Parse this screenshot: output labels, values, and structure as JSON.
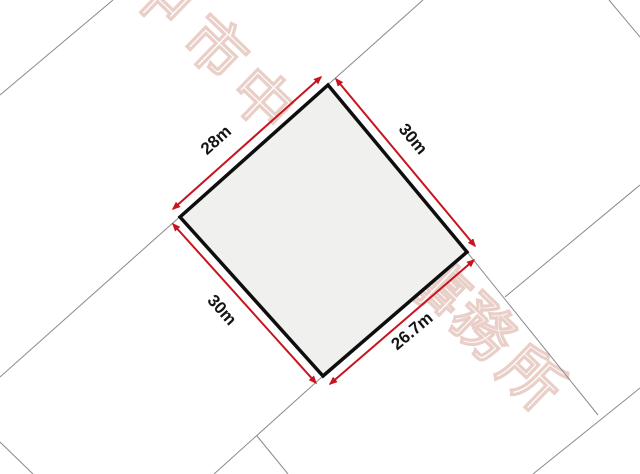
{
  "parcel": {
    "shape": "quadrilateral",
    "sides": [
      {
        "position": "top-left",
        "length_label": "28m",
        "length_m": 28
      },
      {
        "position": "top-right",
        "length_label": "30m",
        "length_m": 30
      },
      {
        "position": "bottom-left",
        "length_label": "30m",
        "length_m": 30
      },
      {
        "position": "bottom-right",
        "length_label": "26.7m",
        "length_m": 26.7
      }
    ]
  },
  "watermark": {
    "visible_text": "中市中事務所",
    "chars": [
      {
        "char": "中"
      },
      {
        "char": "市"
      },
      {
        "char": "中"
      },
      {
        "char": "事"
      },
      {
        "char": "務"
      },
      {
        "char": "所"
      }
    ],
    "color": "#e9cfc8"
  },
  "colors": {
    "background": "#ffffff",
    "parcel_fill": "#f0f0ef",
    "parcel_stroke": "#0e0e0e",
    "boundary_line": "#8a8a8a",
    "dimension_arrow": "#c8141e",
    "dimension_label": "#141414"
  }
}
